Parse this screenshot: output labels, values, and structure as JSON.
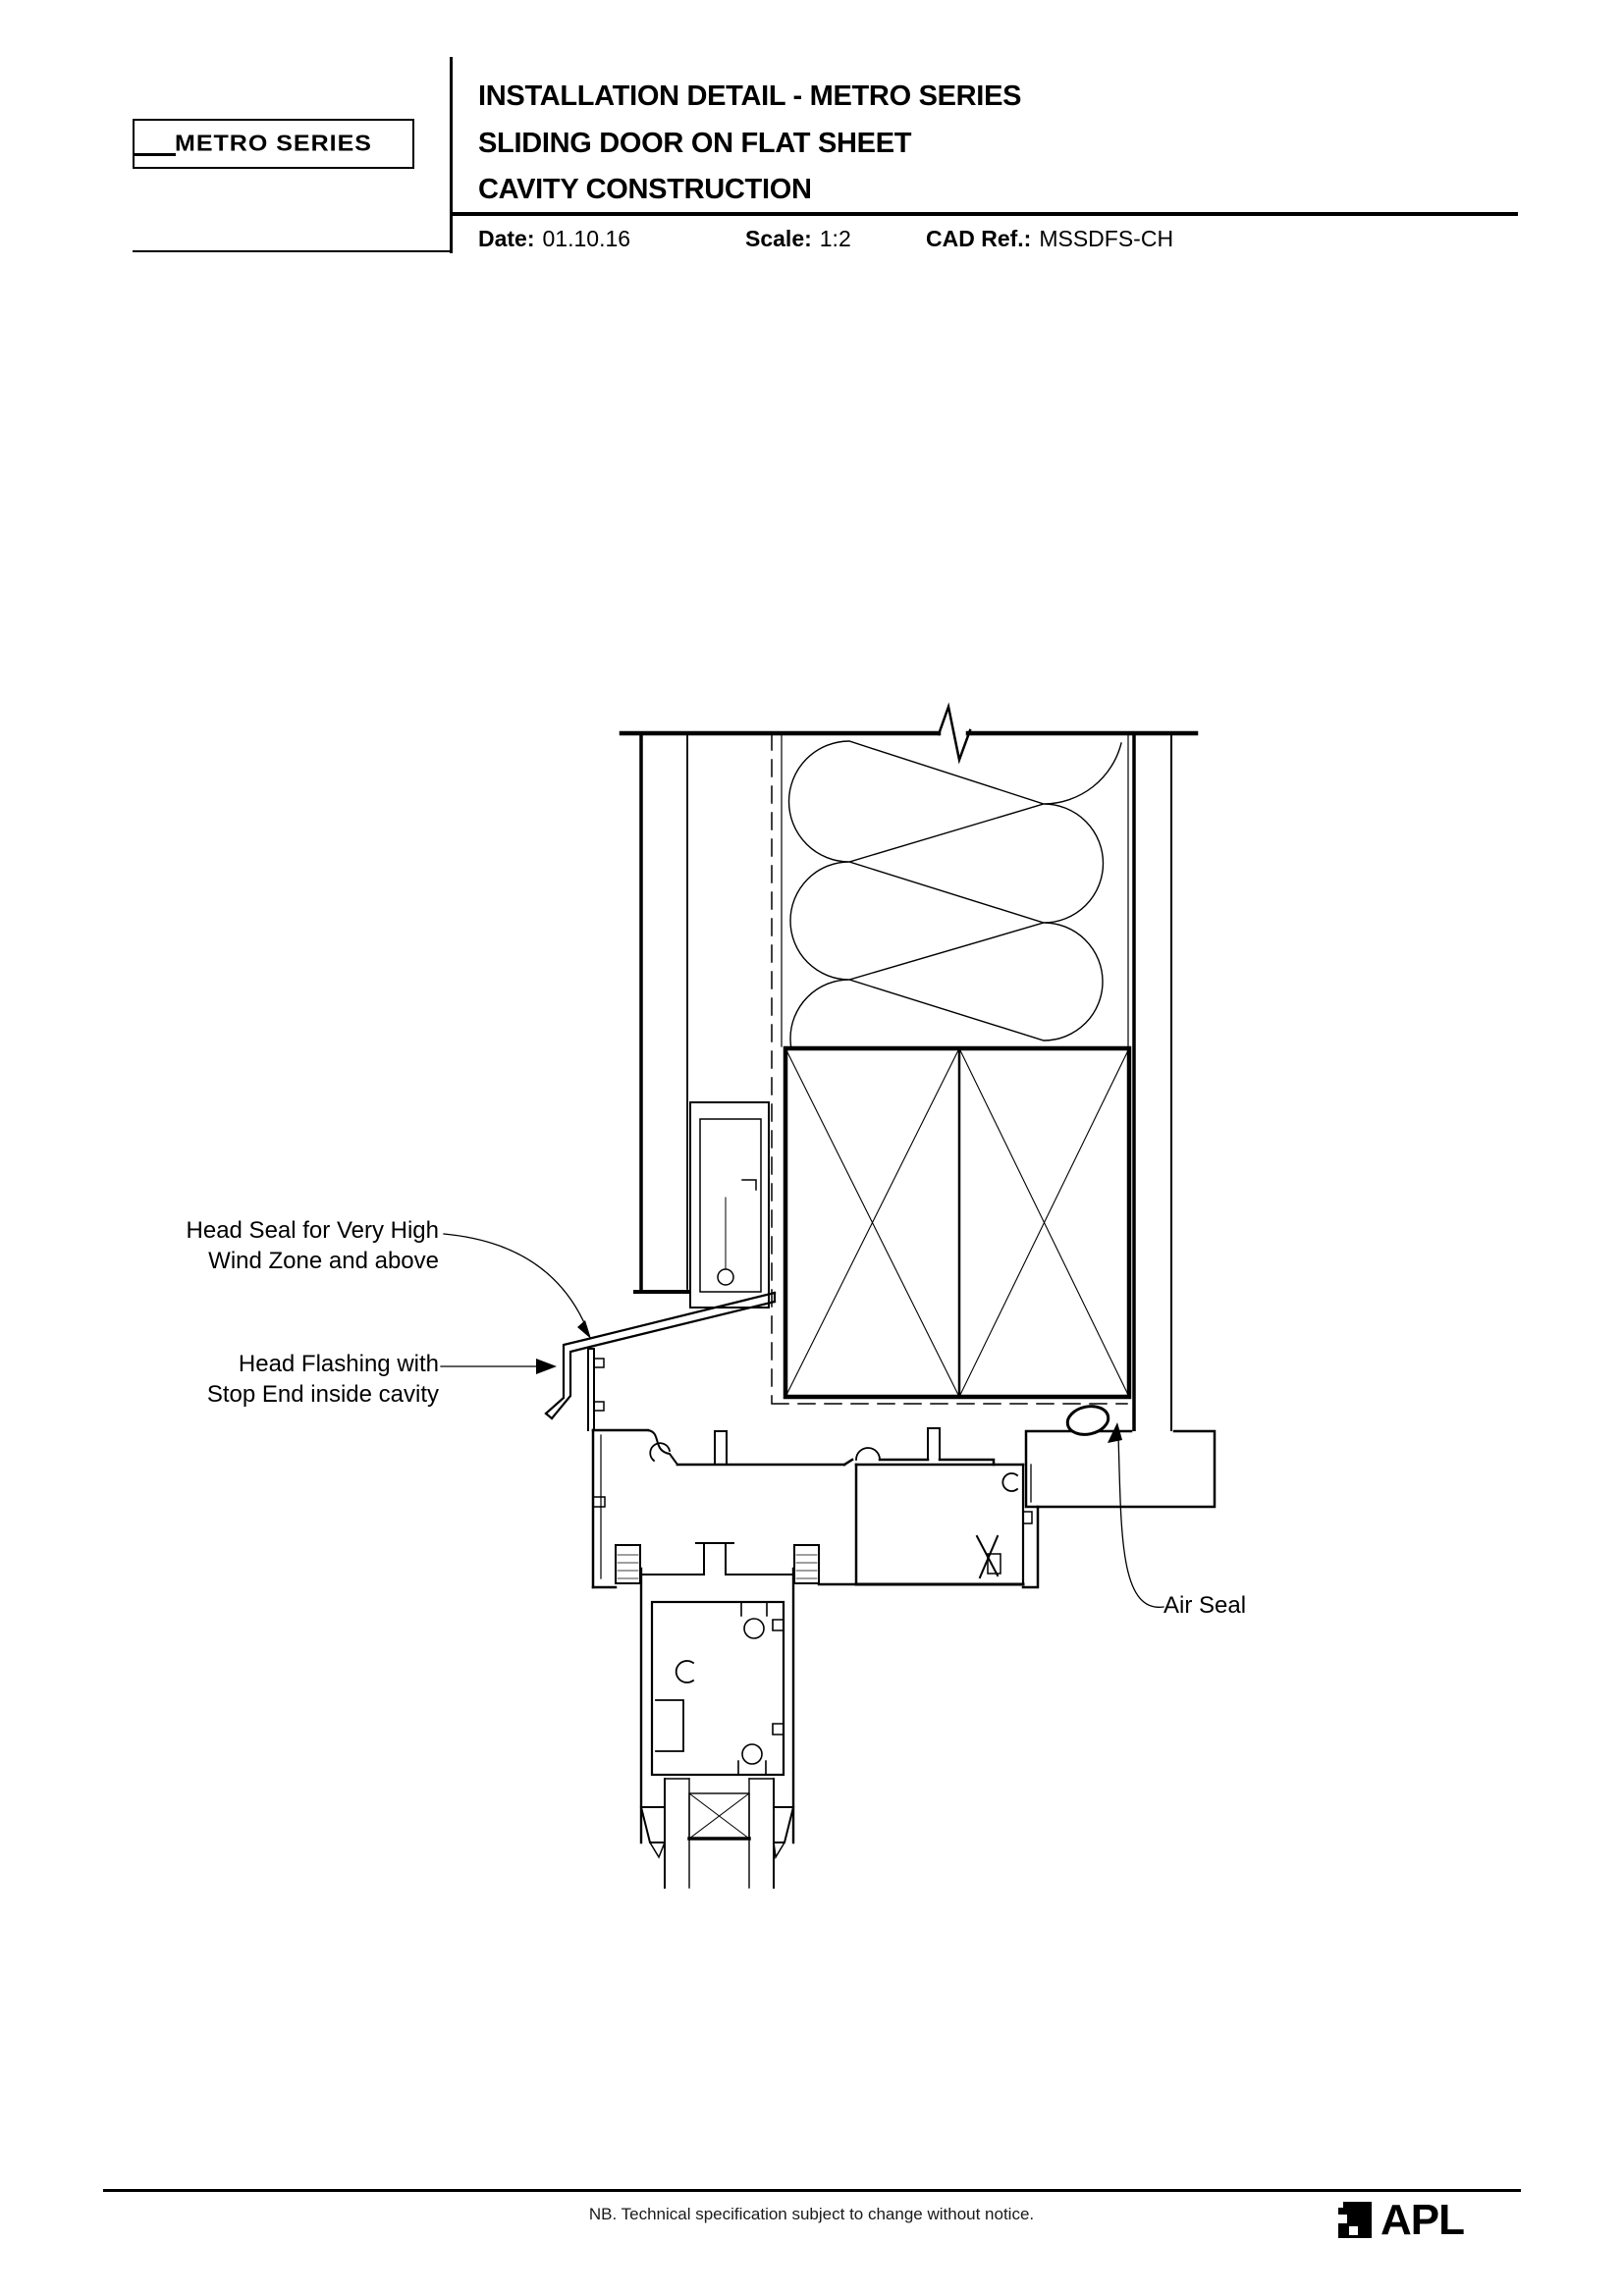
{
  "header": {
    "logo_text": "METRO SERIES",
    "title_line1": "INSTALLATION DETAIL - METRO SERIES",
    "title_line2": "SLIDING DOOR ON FLAT SHEET",
    "title_line3": "CAVITY CONSTRUCTION",
    "date_label": "Date:",
    "date_value": "01.10.16",
    "scale_label": "Scale:",
    "scale_value": "1:2",
    "cad_ref_label": "CAD Ref.:",
    "cad_ref_value": "MSSDFS-CH"
  },
  "drawing": {
    "labels": {
      "head_seal": [
        "Head Seal for Very High",
        "Wind Zone and above"
      ],
      "head_flashing": [
        "Head Flashing with",
        "Stop End inside cavity"
      ],
      "air_seal": "Air Seal"
    },
    "components": [
      "timber-framing-with-batt-insulation",
      "lintel-cross-section",
      "building-wrap-dashed",
      "flat-sheet-cladding-on-cavity-batten",
      "head-flashing-with-stop-end",
      "sliding-door-head-frame-extrusion",
      "sliding-panel-top-rail",
      "double-glazed-unit",
      "interior-lining",
      "timber-reveal",
      "air-seal"
    ]
  },
  "footer": {
    "note": "NB. Technical specification subject to change without notice.",
    "brand": "APL"
  },
  "colors": {
    "line": "#000000",
    "background": "#ffffff"
  }
}
